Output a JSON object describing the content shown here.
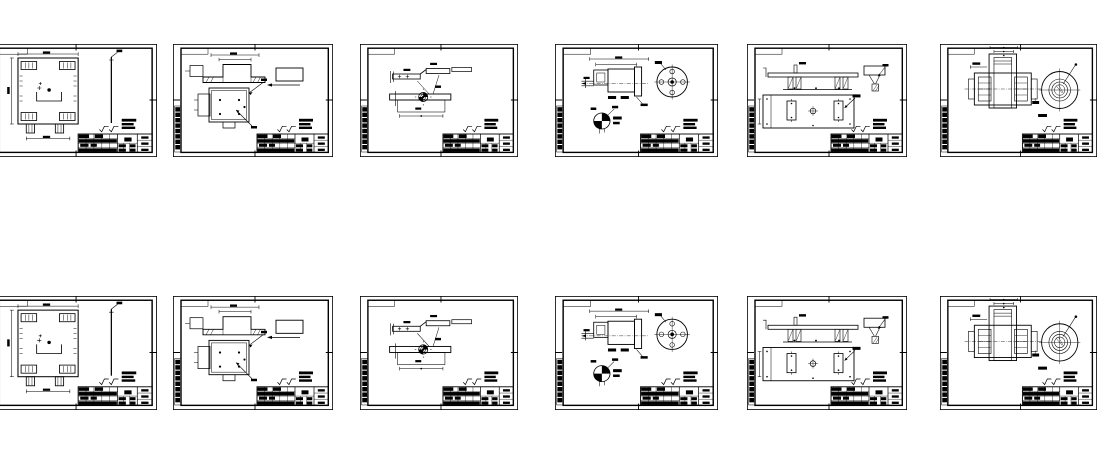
{
  "gallery": {
    "rows": 2,
    "columns": 6,
    "sheet_count": 12,
    "sheets": [
      {
        "row": 1,
        "col": 1,
        "drawing": "base-frame-plate"
      },
      {
        "row": 1,
        "col": 2,
        "drawing": "support-bracket"
      },
      {
        "row": 1,
        "col": 3,
        "drawing": "lever-arm"
      },
      {
        "row": 1,
        "col": 4,
        "drawing": "shaft-with-flange"
      },
      {
        "row": 1,
        "col": 5,
        "drawing": "mounting-plate"
      },
      {
        "row": 1,
        "col": 6,
        "drawing": "pulley-hub"
      },
      {
        "row": 2,
        "col": 1,
        "drawing": "base-frame-plate"
      },
      {
        "row": 2,
        "col": 2,
        "drawing": "support-bracket"
      },
      {
        "row": 2,
        "col": 3,
        "drawing": "lever-arm"
      },
      {
        "row": 2,
        "col": 4,
        "drawing": "shaft-with-flange"
      },
      {
        "row": 2,
        "col": 5,
        "drawing": "mounting-plate"
      },
      {
        "row": 2,
        "col": 6,
        "drawing": "pulley-hub"
      }
    ]
  },
  "colors": {
    "line": "#000000",
    "paper": "#ffffff",
    "background": "#ffffff"
  }
}
